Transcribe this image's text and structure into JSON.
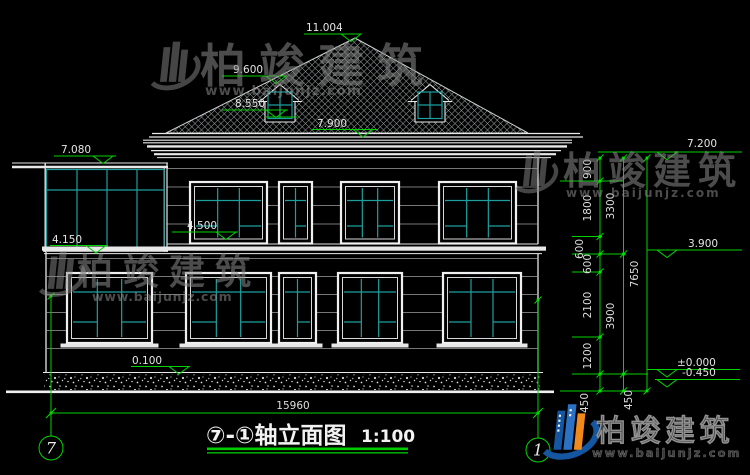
{
  "watermark": {
    "brand": "柏竣建筑",
    "url": "www.baijunjz.com"
  },
  "title": {
    "name": "⑦-①轴立面图",
    "scale": "1:100"
  },
  "axis_bubbles": {
    "left": "7",
    "right": "1"
  },
  "overall_dim": "15960",
  "levels": {
    "peak": "11.004",
    "dormer_top": "9.600",
    "dormer_sill": "8.550",
    "eave": "7.900",
    "sunroom_top": "7.080",
    "sill_2f": "4.500",
    "sunroom_base": "4.150",
    "plinth": "0.100",
    "right_top": "7.200",
    "floor2": "3.900",
    "zero": "±0.000",
    "ground": "-0.450"
  },
  "dims": {
    "inner": [
      "900",
      "1800",
      "600",
      "600",
      "2100",
      "1200",
      "450"
    ],
    "middle": [
      "3300",
      "3900",
      "450"
    ],
    "outer": [
      "7650"
    ]
  },
  "colors": {
    "annotation_green": "#00d400",
    "glazing_teal": "#1e9e9e",
    "line_white": "#e8e8e8",
    "brand_blue": "#1456a0",
    "brand_orange": "#f08a1c"
  }
}
